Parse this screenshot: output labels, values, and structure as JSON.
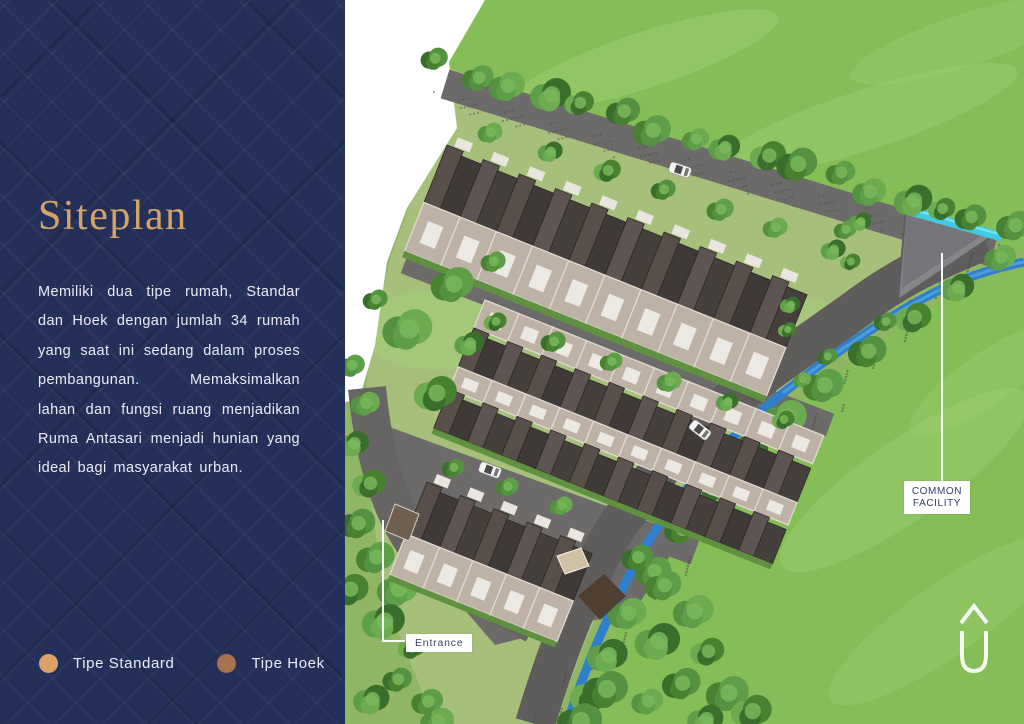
{
  "sidebar": {
    "title": "Siteplan",
    "paragraph_lines": [
      "Memiliki dua tipe rumah, Standar",
      "dan Hoek dengan jumlah 34 rumah",
      "yang saat ini sedang dalam proses",
      "pembangunan. Memaksimalkan",
      "lahan dan fungsi ruang menjadikan",
      "Ruma Antasari menjadi hunian yang",
      "ideal bagi masyarakat urban."
    ],
    "legend": [
      {
        "label": "Tipe Standard",
        "color": "#d9a269"
      },
      {
        "label": "Tipe Hoek",
        "color": "#a8714f"
      }
    ]
  },
  "map": {
    "labels": {
      "common_facility_line1": "COMMON",
      "common_facility_line2": "FACILITY",
      "entrance": "Entrance"
    },
    "icons": {
      "logo": "ruma-house-logo"
    },
    "colors": {
      "navy": "#243059",
      "title_gold": "#d3a368",
      "base_green": "#8fb565",
      "field_green": "#85bd56",
      "field_light": "#a4d578",
      "site_green": "#a6c07c",
      "road_gray": "#6c6b69",
      "river_road": "#5e5d5b",
      "river_blue": "#2e80cc",
      "stream_cyan": "#40cbe4",
      "roof_dark": "#3f3a38",
      "roof_light": "#584f4b",
      "drive_beige": "#beb1a6",
      "divider": "#e2dbd1",
      "green_strip": "#5f9140",
      "facility_gray": "#86868a",
      "label_text": "#333f6b"
    }
  }
}
